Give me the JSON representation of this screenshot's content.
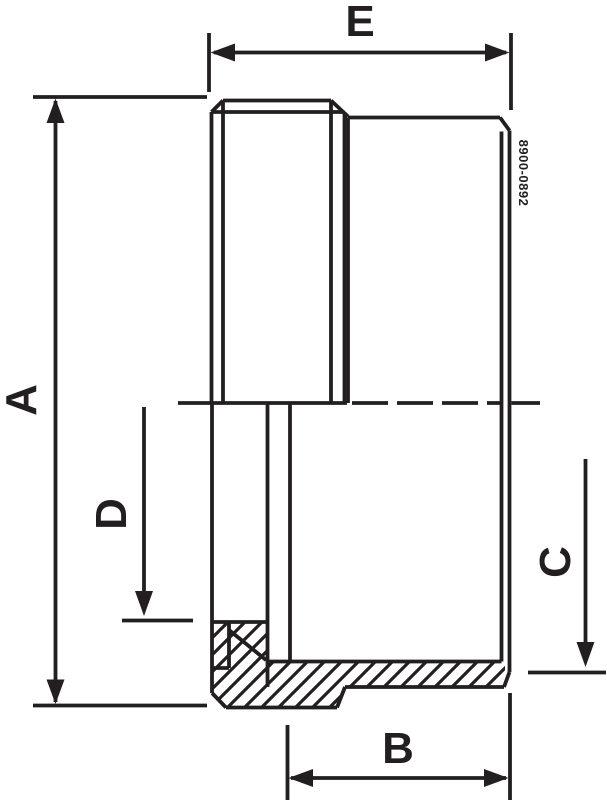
{
  "drawing": {
    "title": "dimension-drawing",
    "labels": {
      "a": "A",
      "b": "B",
      "c": "C",
      "d": "D",
      "e": "E"
    },
    "part_number": "8900-0892",
    "colors": {
      "line": "#231f20",
      "background": "#ffffff"
    }
  }
}
